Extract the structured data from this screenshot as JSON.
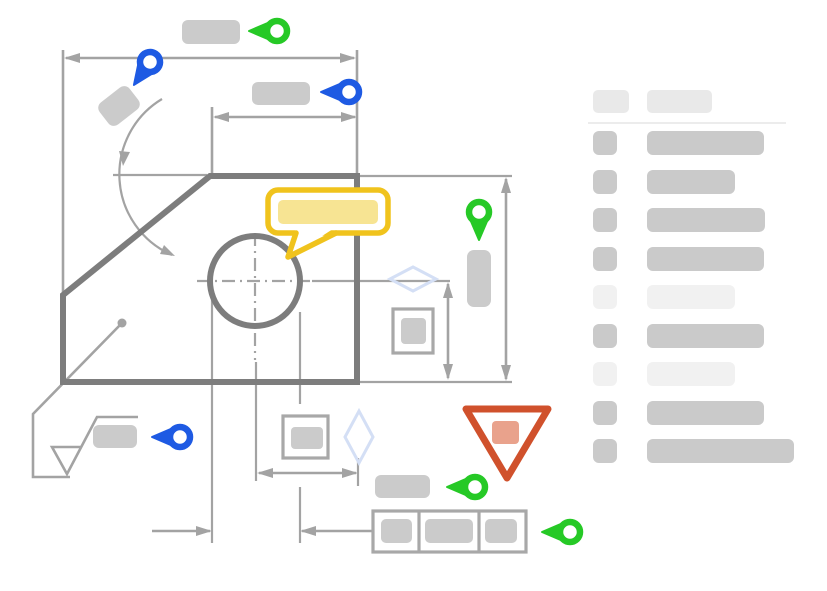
{
  "title": "annotated-engineering-drawing-mock",
  "colors": {
    "green": "#26c926",
    "blue": "#1e5ae3",
    "yellow": "#f0c31d",
    "yellow_fill": "#f7e493",
    "red": "#d0512c",
    "red_fill": "#e9a28c",
    "part_gray": "#7d7d7d",
    "line_gray": "#a3a3a3",
    "box_gray": "#a8a8a8",
    "chip_gray": "#cbcbcb",
    "skeleton_dark": "#cacaca",
    "skeleton_light": "#e9e9e9",
    "skeleton_lighter": "#f1f1f1",
    "divider": "#ececec",
    "diamond_blue": "#d4dff5"
  },
  "drawing": {
    "description": "engineering part drawing with hole, chamfer, dimensions, datum/surface symbol, feature control frame, comment bubble, warning marker",
    "pins": [
      {
        "id": "pin-green-top",
        "color": "green",
        "x": 277,
        "y": 31,
        "rotate": 0
      },
      {
        "id": "pin-blue-top-right",
        "color": "blue",
        "x": 349,
        "y": 92,
        "rotate": 0
      },
      {
        "id": "pin-blue-top-left",
        "color": "blue",
        "x": 150,
        "y": 62,
        "rotate": -55
      },
      {
        "id": "pin-green-middle",
        "color": "green",
        "x": 479,
        "y": 212,
        "rotate": -90
      },
      {
        "id": "pin-blue-bottom-left",
        "color": "blue",
        "x": 180,
        "y": 437,
        "rotate": 0
      },
      {
        "id": "pin-green-bottom",
        "color": "green",
        "x": 475,
        "y": 487,
        "rotate": 0
      },
      {
        "id": "pin-green-bottom-right",
        "color": "green",
        "x": 570,
        "y": 532,
        "rotate": 0
      }
    ],
    "label_placeholders": 6,
    "comment_bubble": {
      "present": true,
      "text": ""
    },
    "warning_marker": {
      "present": true
    },
    "feature_control_frame_cells": 3
  },
  "sidebar": {
    "header": {
      "square": true,
      "bar": true
    },
    "rows": [
      {
        "tone": "dark",
        "bar_width": 117
      },
      {
        "tone": "dark",
        "bar_width": 88
      },
      {
        "tone": "dark",
        "bar_width": 118
      },
      {
        "tone": "dark",
        "bar_width": 117
      },
      {
        "tone": "light",
        "bar_width": 88
      },
      {
        "tone": "dark",
        "bar_width": 117
      },
      {
        "tone": "light",
        "bar_width": 88
      },
      {
        "tone": "dark",
        "bar_width": 117
      },
      {
        "tone": "dark",
        "bar_width": 147
      }
    ]
  }
}
